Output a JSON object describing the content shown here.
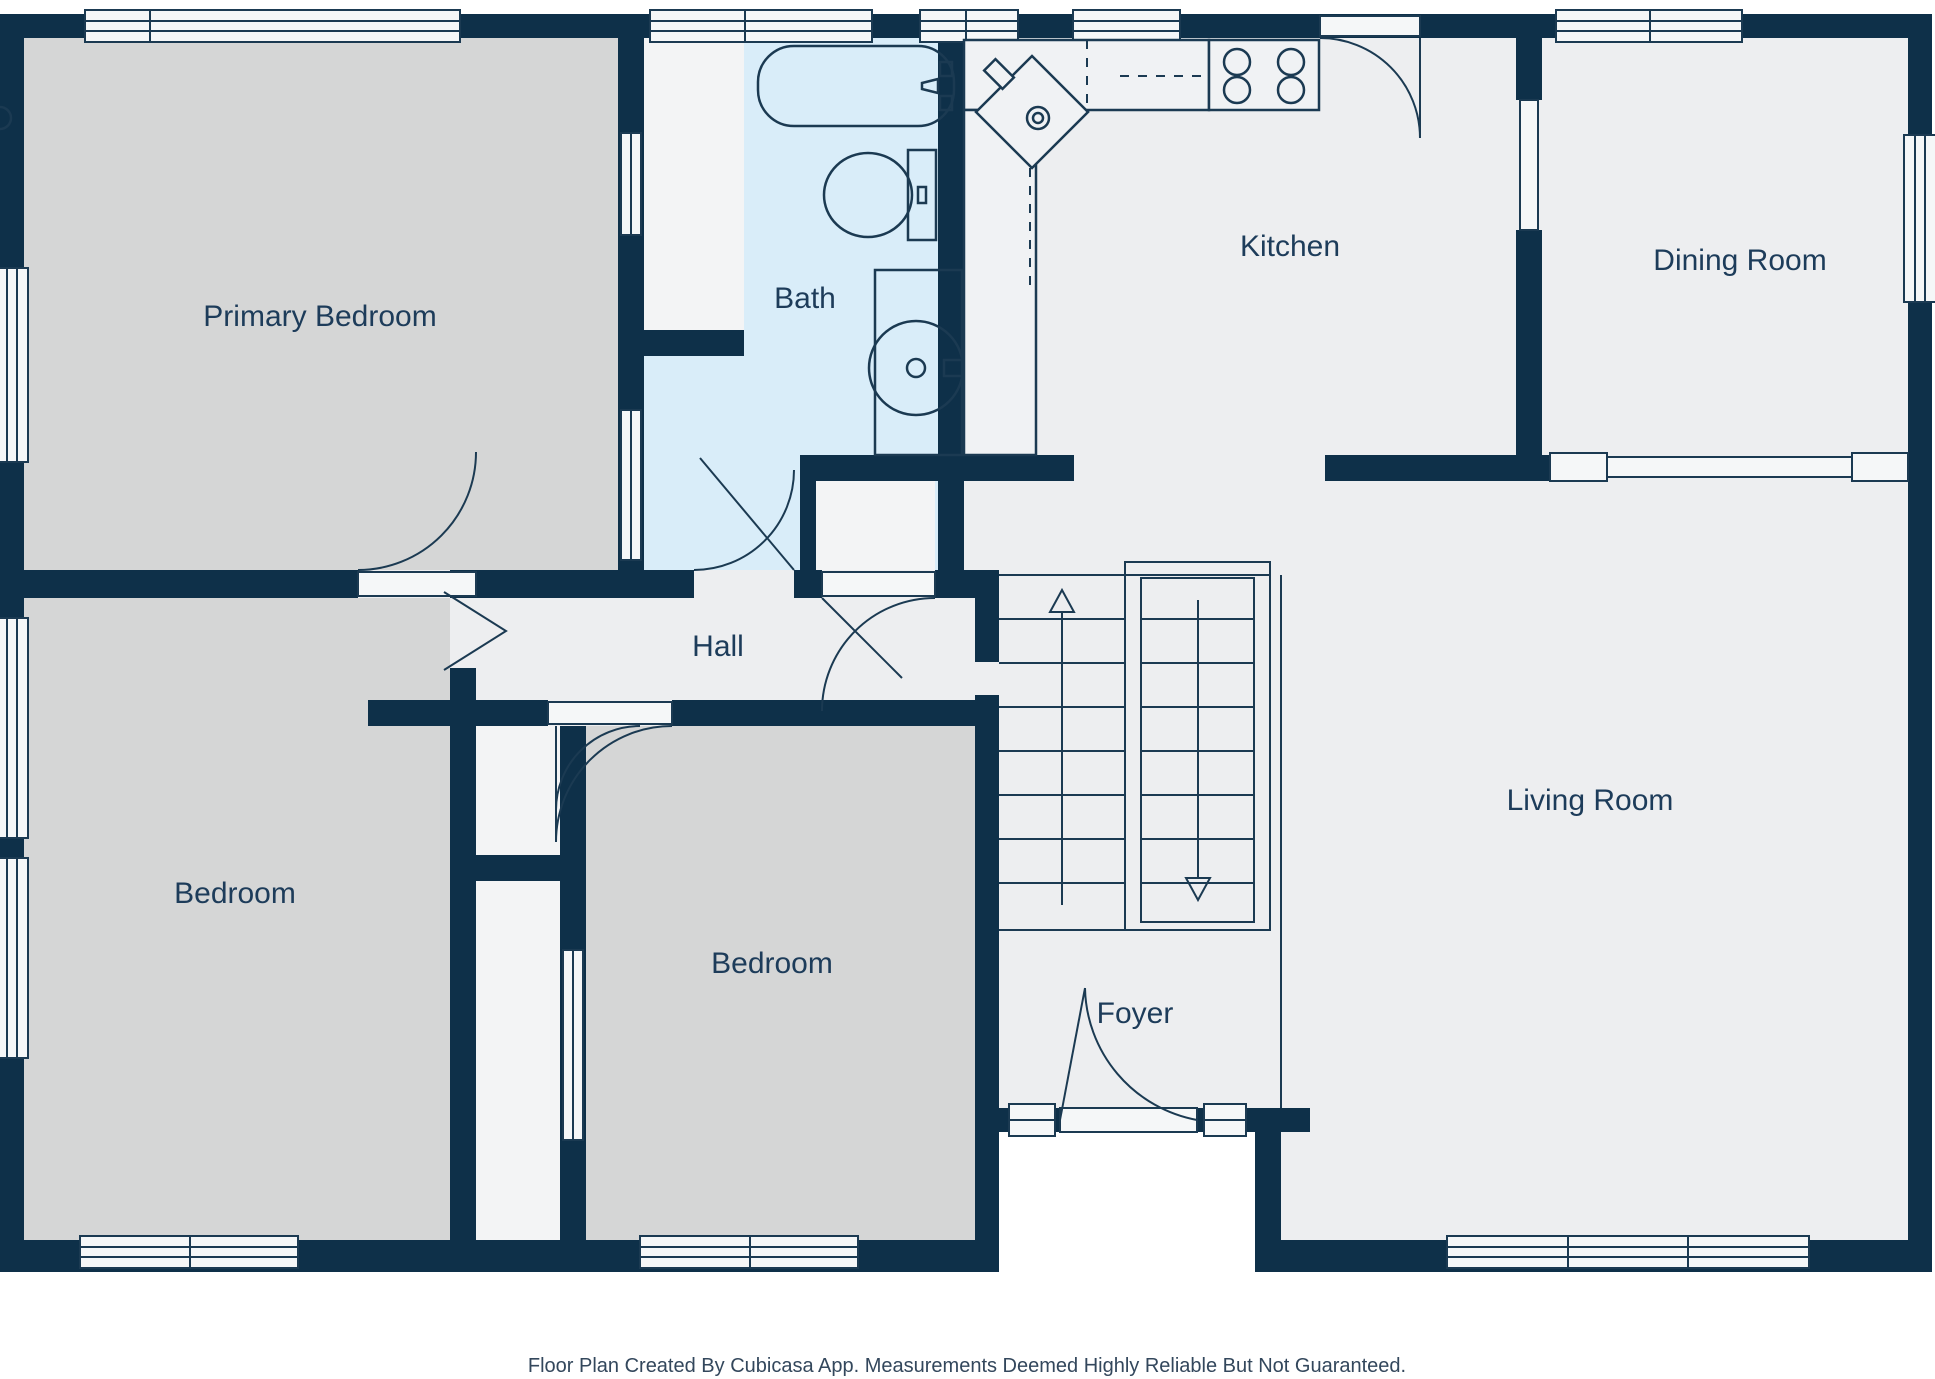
{
  "labels": {
    "primary_bedroom": "Primary Bedroom",
    "bath": "Bath",
    "kitchen": "Kitchen",
    "dining_room": "Dining Room",
    "hall": "Hall",
    "bedroom_left": "Bedroom",
    "bedroom_middle": "Bedroom",
    "living_room": "Living Room",
    "foyer": "Foyer"
  },
  "footer": {
    "credit": "Floor Plan Created By Cubicasa App. Measurements Deemed Highly Reliable But Not Guaranteed."
  },
  "colors": {
    "wall": "#0e3049",
    "room_default": "#edeef0",
    "bedroom": "#d5d6d6",
    "bath": "#d9edf9",
    "closet": "#f3f4f5",
    "window": "#f5f7f8",
    "label_text": "#1d3c5a"
  },
  "fixtures": [
    "bathtub",
    "toilet",
    "bathroom-sink",
    "kitchen-corner-sink",
    "stove-4-burners",
    "kitchen-counters",
    "upper-cabinet-dashed-lines",
    "staircase-up-flight",
    "staircase-down-flight",
    "entry-door-with-sidelights"
  ],
  "stairs": {
    "up_arrow": "up",
    "down_arrow": "down",
    "treads_per_flight": 8
  }
}
